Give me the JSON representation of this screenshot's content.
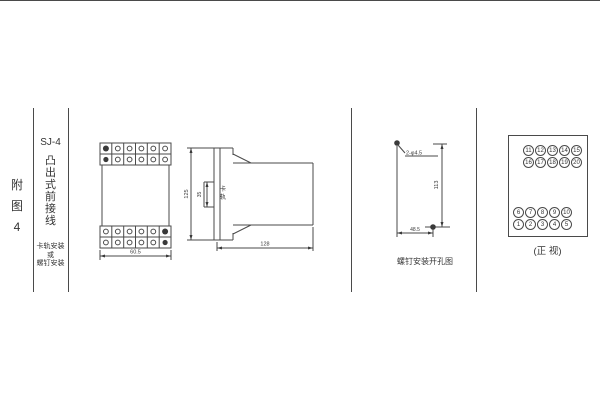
{
  "figure": {
    "index_label": "附图4",
    "model": "SJ-4",
    "type_label": "凸出式前接线",
    "mount_note": [
      "卡轨安装",
      "或",
      "螺钉安装"
    ]
  },
  "front_view": {
    "width_dim": "60.5"
  },
  "side_view": {
    "height_dim": "125",
    "rail_dim": "35",
    "rail_label": "卡轨",
    "depth_dim": "128"
  },
  "drill_view": {
    "holes_label": "2-φ4.5",
    "vertical_dim": "113",
    "horizontal_dim": "48.5",
    "caption": "螺钉安装开孔图"
  },
  "terminal_view": {
    "caption": "(正 视)",
    "upper": [
      [
        "11",
        "12",
        "13",
        "14",
        "15"
      ],
      [
        "16",
        "17",
        "18",
        "19",
        "20"
      ]
    ],
    "lower": [
      [
        "6",
        "7",
        "8",
        "9",
        "10"
      ],
      [
        "1",
        "2",
        "3",
        "4",
        "5"
      ]
    ]
  },
  "colors": {
    "line": "#4a4a4a",
    "text": "#333333",
    "background": "#ffffff"
  }
}
